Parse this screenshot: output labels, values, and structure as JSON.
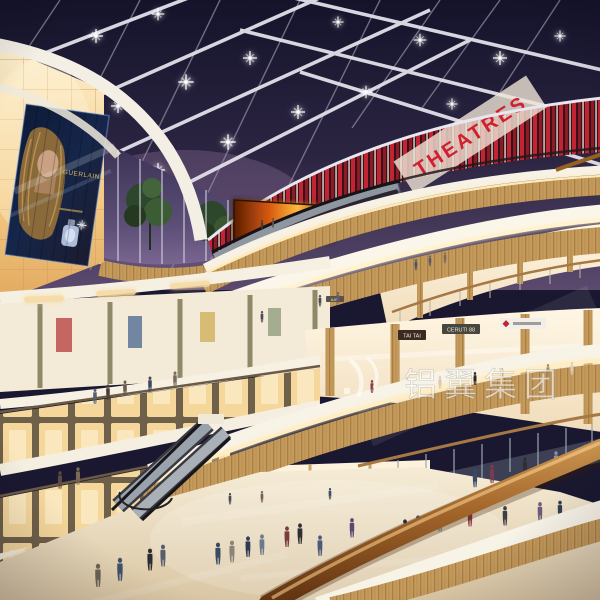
{
  "scene": {
    "description": "Night interior rendering of a multi-level shopping mall atrium: glass skylight roof with lit beams, red THEATRES level, curved cream and wood balconies with shops, escalators, glowing amber lightbox wall with perfume billboard, shoppers on reflective floor, wooden handrail in foreground",
    "setting": "shopping mall atrium",
    "time": "night"
  },
  "signs": {
    "theatre": "THEATRES",
    "tai_tai": "TAI TAI",
    "ceruti": "CERUTI 88",
    "ajpi": "AJPI"
  },
  "billboard": {
    "brand": "GUERLAIN",
    "subject": "perfume advertisement with blonde woman and bottle"
  },
  "watermark": {
    "text": "铝翼集团"
  },
  "palette": {
    "sky": "#191731",
    "beam": "#e2e0ea",
    "theatre_red": "#c22433",
    "amber_panel": "#f5d79b",
    "wood": "#c49a5d",
    "fascia_white": "#f8f3e7",
    "floor": "#e9dcc0",
    "rail_wood": "#a3662a",
    "fire_screen": "#ff8c1e"
  }
}
